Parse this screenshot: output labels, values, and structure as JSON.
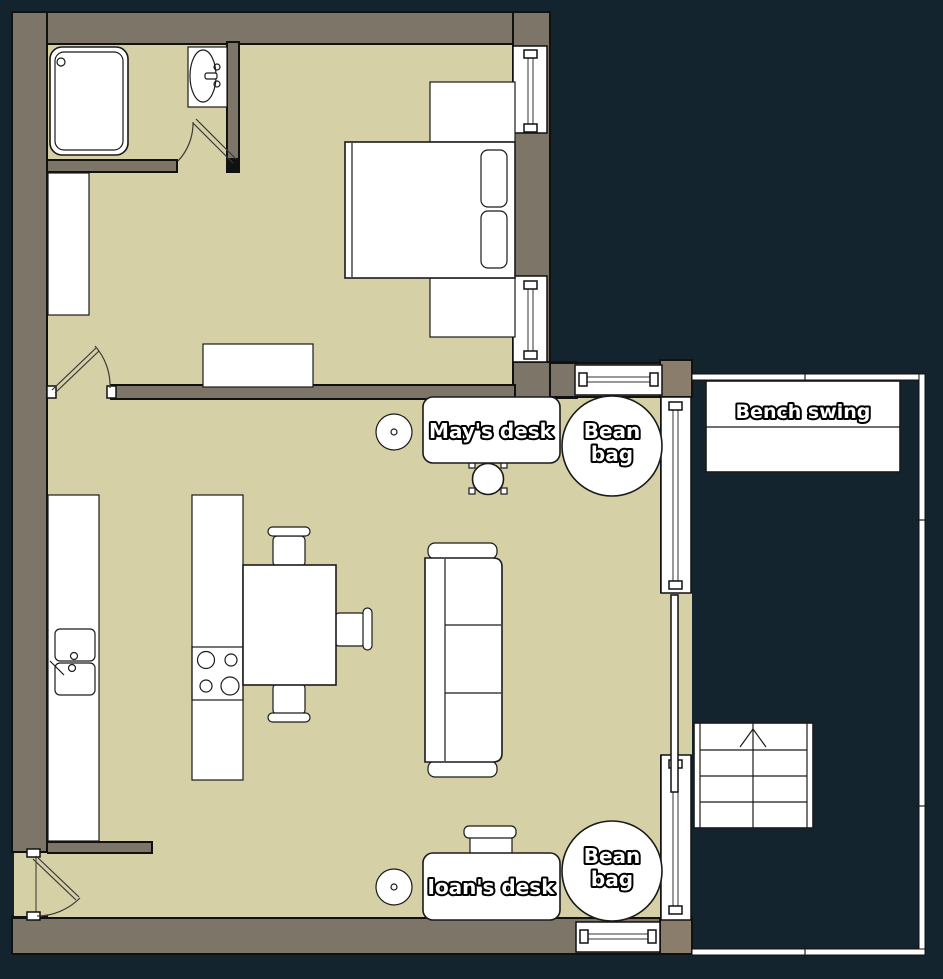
{
  "floorplan": {
    "labels": {
      "may_desk": "May's desk",
      "bean_bag_top_line1": "Bean",
      "bean_bag_top_line2": "bag",
      "bench_swing": "Bench swing",
      "ioan_desk": "Ioan's desk",
      "bean_bag_bottom_line1": "Bean",
      "bean_bag_bottom_line2": "bag"
    },
    "colors": {
      "background": "#13242e",
      "wall": "#7d7567",
      "wall_post": "#8a7d6b",
      "floor": "#d6d0a6",
      "furniture": "#ffffff",
      "outline": "#111111",
      "label_fill": "#ffffff",
      "label_stroke": "#000000"
    }
  }
}
